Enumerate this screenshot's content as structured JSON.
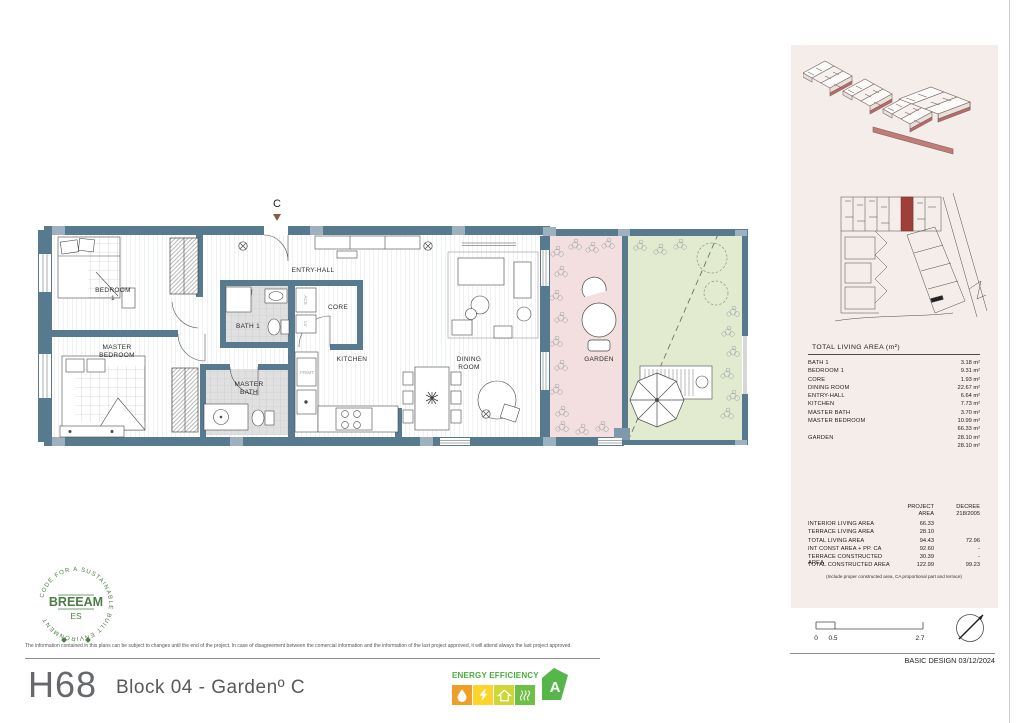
{
  "plan": {
    "section_label": "C",
    "rooms": {
      "bedroom1_l1": "BEDROOM",
      "bedroom1_l2": "1",
      "master_l1": "MASTER",
      "master_l2": "BEDROOM",
      "bath1": "BATH 1",
      "master_bath_l1": "MASTER",
      "master_bath_l2": "BATH",
      "core": "CORE",
      "entry_hall": "ENTRY-HALL",
      "kitchen": "KITCHEN",
      "dining_l1": "DINING",
      "dining_l2": "ROOM",
      "garden": "GARDEN",
      "acs": "ACS",
      "lv": "LV",
      "frmt": "FR/MT"
    }
  },
  "panel": {
    "area_table": {
      "title": "TOTAL LIVING AREA (m²)",
      "rows": [
        {
          "label": "BATH 1",
          "value": "3.18 m²"
        },
        {
          "label": "BEDROOM 1",
          "value": "9.31 m²"
        },
        {
          "label": "CORE",
          "value": "1.93 m²"
        },
        {
          "label": "DINING ROOM",
          "value": "22.67 m²"
        },
        {
          "label": "ENTRY-HALL",
          "value": "6.64 m²"
        },
        {
          "label": "KITCHEN",
          "value": "7.73 m²"
        },
        {
          "label": "MASTER BATH",
          "value": "3.70 m²"
        },
        {
          "label": "MASTER BEDROOM",
          "value": "10.99 m²"
        },
        {
          "label": "",
          "value": "66.33 m²"
        },
        {
          "label": "GARDEN",
          "value": "28.10 m²"
        },
        {
          "label": "",
          "value": "28.10 m²"
        }
      ]
    },
    "summary_table": {
      "col1_header_l1": "PROJECT",
      "col1_header_l2": "AREA",
      "col2_header_l1": "DECREE",
      "col2_header_l2": "218/2005",
      "rows": [
        {
          "label": "INTERIOR LIVING AREA",
          "project": "66.33",
          "decree": ""
        },
        {
          "label": "TERRACE LIVING AREA",
          "project": "28.10",
          "decree": ""
        },
        {
          "label": "TOTAL LIVING AREA",
          "project": "94.43",
          "decree": "72.96"
        },
        {
          "label": "INT CONST AREA + PP. CA",
          "project": "92.60",
          "decree": "-"
        },
        {
          "label": "TERRACE CONSTRUCTED AREA",
          "project": "30.39",
          "decree": "-"
        },
        {
          "label": "TOTAL CONSTRUCTED AREA",
          "project": "122.99",
          "decree": "99.23"
        }
      ],
      "footnote": "(Include proper constructed area, CA proportional part and terrace)"
    },
    "scale": {
      "t0": "0",
      "t1": "0.5",
      "t2": "2.7"
    },
    "stamp": "BASIC DESIGN 03/12/2024"
  },
  "footer": {
    "disclaimer": "The information contained in this plans can be subject to changes until the end of the project. In case of disagreement between the comercial information and the information of the last project approved, it will attend always the last project approved.",
    "unit_code": "H68",
    "unit_title": "Block 04 -  Gardenº C",
    "energy": {
      "title": "ENERGY EFFICIENCY",
      "rating": "A"
    },
    "breeam": {
      "ring": "CODE FOR A SUSTAINABLE BUILT ENVIRONMENT",
      "name": "BREEAM",
      "sub": "ES"
    }
  },
  "colors": {
    "wall": "#587a8f",
    "pillar": "#9db1be",
    "terrace": "#f3dfdf",
    "garden": "#e2ebcf",
    "panel_bg": "#f4ede9",
    "breeam_green": "#4b7d45",
    "energy_green": "#56b649",
    "energy_orange": "#ee9f2a",
    "energy_yellow": "#fed42c",
    "energy_lime": "#cfd637",
    "highlight_red": "#9e3f39",
    "text_gray": "#67686b"
  }
}
